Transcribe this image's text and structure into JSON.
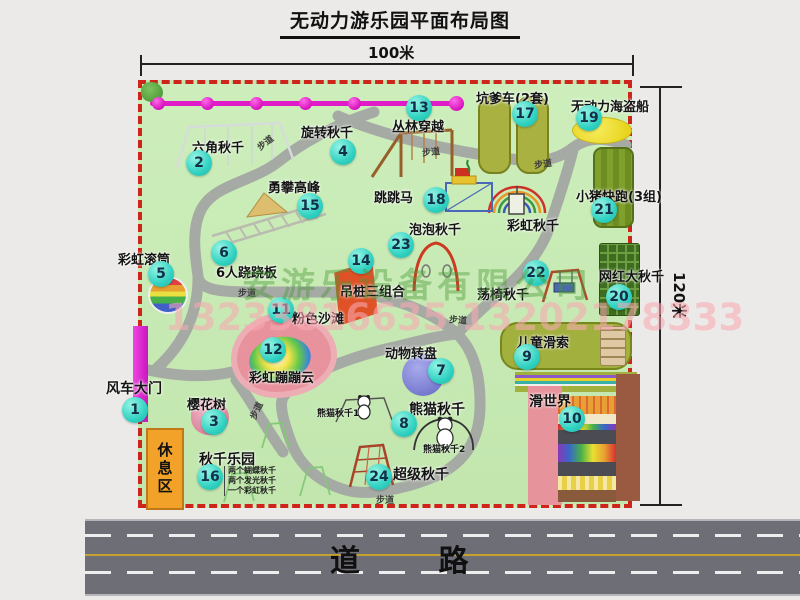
{
  "title": "无动力游乐园平面布局图",
  "dimensions": {
    "top": "100米",
    "right": "120米"
  },
  "road_label": "道 路",
  "rest_area_label": "休息区",
  "path_label": "步道",
  "watermark": {
    "company": "安游乐设备有限公司",
    "phones": "13233816635 13202178333"
  },
  "extra_labels": {
    "rainbow_swing": "彩虹秋千",
    "panda1": "熊猫秋千1",
    "panda2": "熊猫秋千2"
  },
  "swing_park_items": [
    "两个蝴蝶秋千",
    "两个发光秋千",
    "一个彩虹秋千"
  ],
  "colors": {
    "map_bg": "#c7eab4",
    "border_dash": "#cf241c",
    "badge": "#2ed0c0",
    "zipline": "#e01cc8",
    "gate": "#df2cd8",
    "rest_area": "#f2a228",
    "road": "#6e6e76",
    "path": "#a6aaa4"
  },
  "attractions": [
    {
      "num": "1",
      "name": "风车大门"
    },
    {
      "num": "2",
      "name": "六角秋千"
    },
    {
      "num": "3",
      "name": "樱花树"
    },
    {
      "num": "4",
      "name": "旋转秋千"
    },
    {
      "num": "5",
      "name": "彩虹滚筒"
    },
    {
      "num": "6",
      "name": "6人跷跷板"
    },
    {
      "num": "7",
      "name": "动物转盘"
    },
    {
      "num": "8",
      "name": "熊猫秋千"
    },
    {
      "num": "9",
      "name": "儿童滑索"
    },
    {
      "num": "10",
      "name": "滑世界"
    },
    {
      "num": "11",
      "name": "粉色沙滩"
    },
    {
      "num": "12",
      "name": "彩虹蹦蹦云"
    },
    {
      "num": "13",
      "name": "丛林穿越"
    },
    {
      "num": "14",
      "name": "吊桩三组合"
    },
    {
      "num": "15",
      "name": "勇攀高峰"
    },
    {
      "num": "16",
      "name": "秋千乐园"
    },
    {
      "num": "17",
      "name": "坑爹车(2套)"
    },
    {
      "num": "18",
      "name": "跳跳马"
    },
    {
      "num": "19",
      "name": "无动力海盗船"
    },
    {
      "num": "20",
      "name": "网红大秋千"
    },
    {
      "num": "21",
      "name": "小猪快跑(3组)"
    },
    {
      "num": "22",
      "name": "荡椅秋千"
    },
    {
      "num": "23",
      "name": "泡泡秋千"
    },
    {
      "num": "24",
      "name": "超级秋千"
    }
  ]
}
